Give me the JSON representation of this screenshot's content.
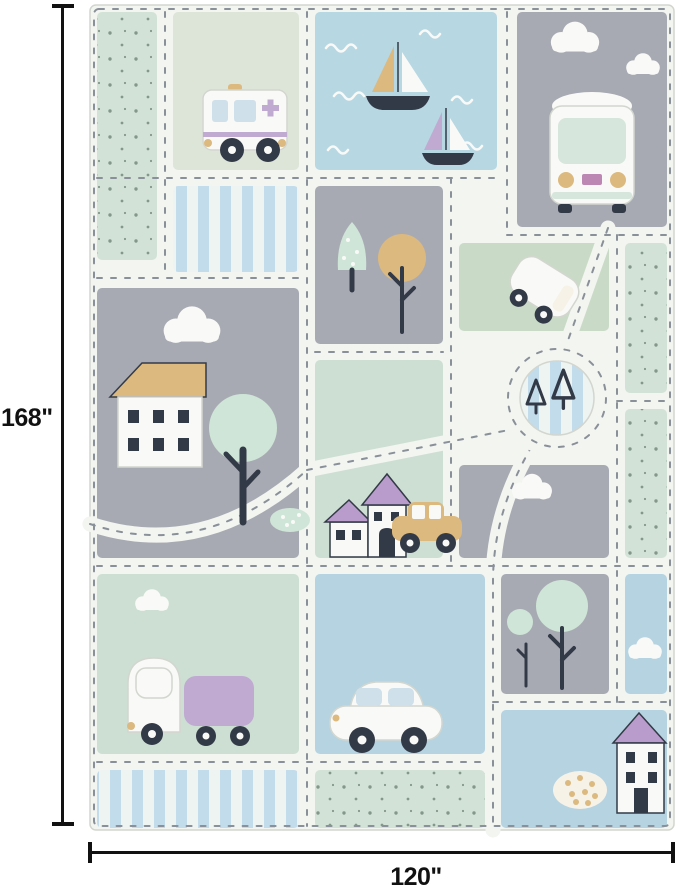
{
  "image": {
    "type": "product-dimension-image",
    "subject": "kids road-map play rug with vehicles, houses, trees and boats"
  },
  "dimensions": {
    "height": "168\"",
    "width": "120\""
  },
  "palette": {
    "bg": "#ffffff",
    "line": "#111111",
    "road": "#f3f5f1",
    "dash": "#8a9099",
    "gray": "#a8aab3",
    "mint": "#cddfd3",
    "sage": "#dde5d9",
    "green": "#c9dbc7",
    "water": "#b7d7e3",
    "blue": "#b5d3e1",
    "dots_base": "#d3e2d7",
    "stripe_blue": "#c3dceb",
    "stripe_white": "#eef4f2",
    "white": "#f9faf7",
    "outline": "#d3d6cf",
    "dark": "#333a47",
    "purple": "#b99ccb",
    "lavender": "#c0aad2",
    "tan": "#dcb97e",
    "mint_tree": "#cfe5d7",
    "mint_window": "#d6e6dc",
    "window_blue": "#cfe0ea",
    "cream": "#f6f2e8",
    "dot": "#84978b",
    "plate": "#bd87b4"
  }
}
